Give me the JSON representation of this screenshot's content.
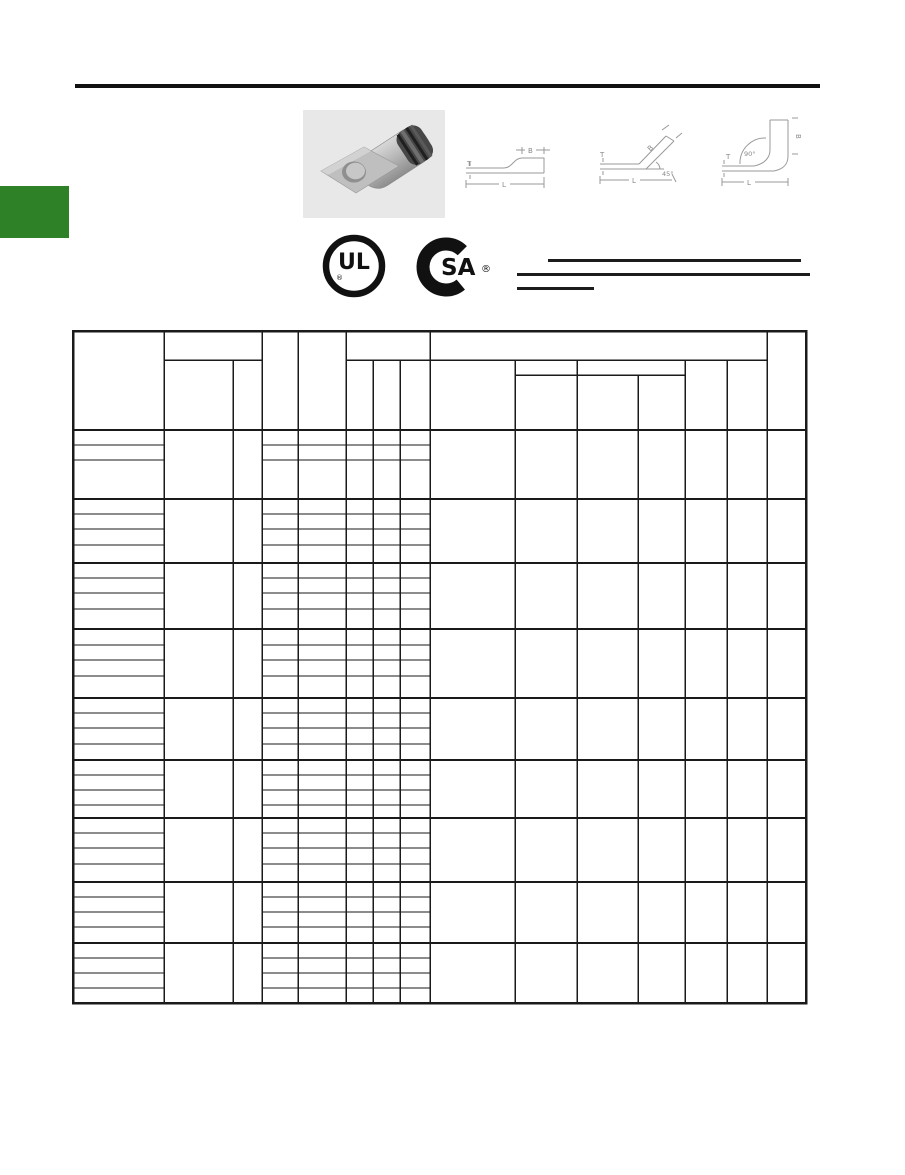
{
  "logos": {
    "ul": {
      "letters": "UL",
      "registered": "®"
    },
    "csa": {
      "letters": "SA",
      "registered": "®"
    }
  },
  "diagrams": {
    "straight": {
      "b": "B",
      "t": "T",
      "l": "L"
    },
    "angle45": {
      "b": "B",
      "t": "T",
      "l": "L",
      "angle": "45°"
    },
    "angle90": {
      "b": "B",
      "t": "T",
      "l": "L",
      "angle": "90°"
    }
  },
  "colors": {
    "accent_green": "#2e8127",
    "table_line": "#1a1a1a",
    "diagram_gray": "#999999",
    "photo_background": "#e8e8e8"
  }
}
